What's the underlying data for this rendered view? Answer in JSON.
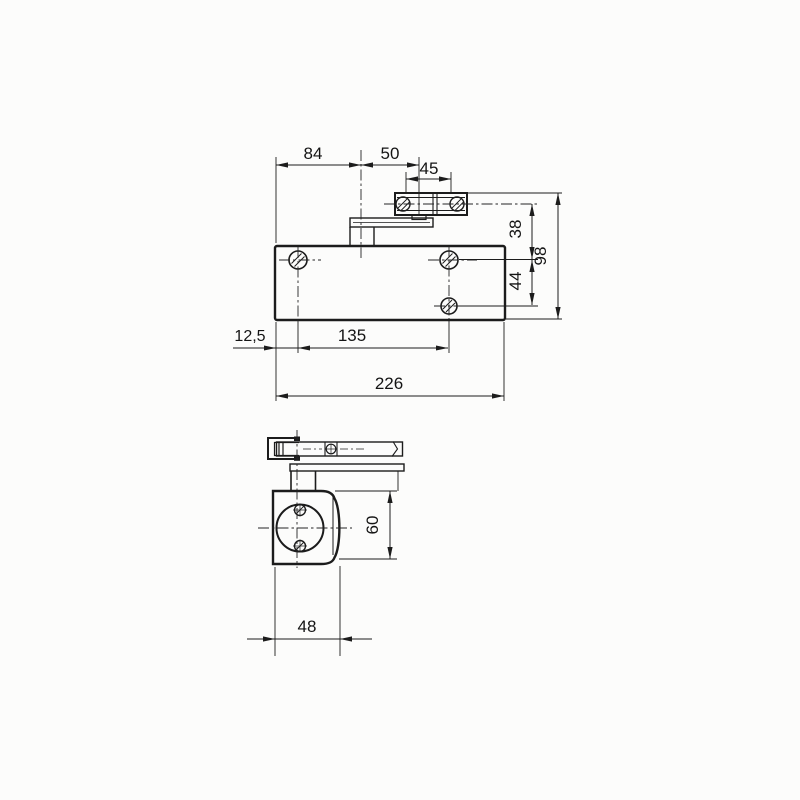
{
  "drawing": {
    "kind": "technical dimension drawing",
    "subject": "overhead door closer with slide arm, scanned line drawing",
    "views": {
      "front": "front elevation",
      "side": "side view"
    },
    "line_color": "#1c1c1c",
    "background": "#fcfcfb"
  },
  "dims": {
    "d84": "84",
    "d50": "50",
    "d45": "45",
    "d38": "38",
    "d98": "98",
    "d44": "44",
    "d12_5": "12,5",
    "d135": "135",
    "d226": "226",
    "d60": "60",
    "d48": "48"
  }
}
